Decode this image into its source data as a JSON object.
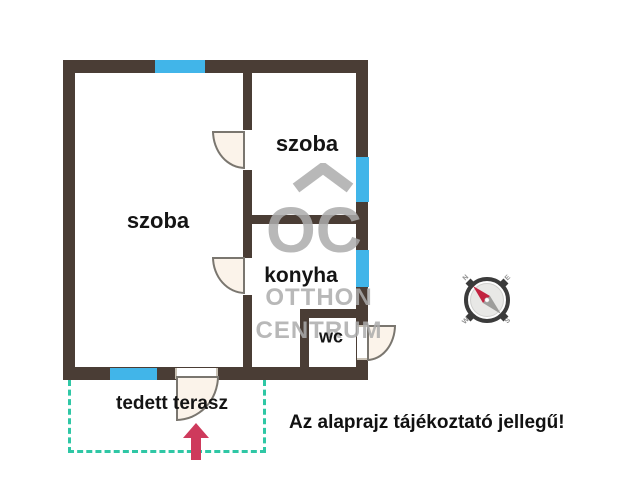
{
  "rooms": {
    "szoba_left": "szoba",
    "szoba_right": "szoba",
    "konyha": "konyha",
    "wc": "wc",
    "terasz": "tedett terasz"
  },
  "disclaimer": "Az alaprajz tájékoztató jellegű!",
  "watermark": {
    "line1": "OC",
    "line2": "OTTHON",
    "line3": "CENTRUM"
  },
  "compass": {
    "n": "N",
    "e": "E",
    "s": "S",
    "w": "W"
  },
  "colors": {
    "wall": "#4a3d35",
    "window_blue": "#41b5e9",
    "terrace_dash_teal": "#2fc7a5",
    "entrance_arrow_red": "#ce3a5c",
    "door_fill": "#fbf3ea",
    "watermark_gray": "#acacac"
  }
}
